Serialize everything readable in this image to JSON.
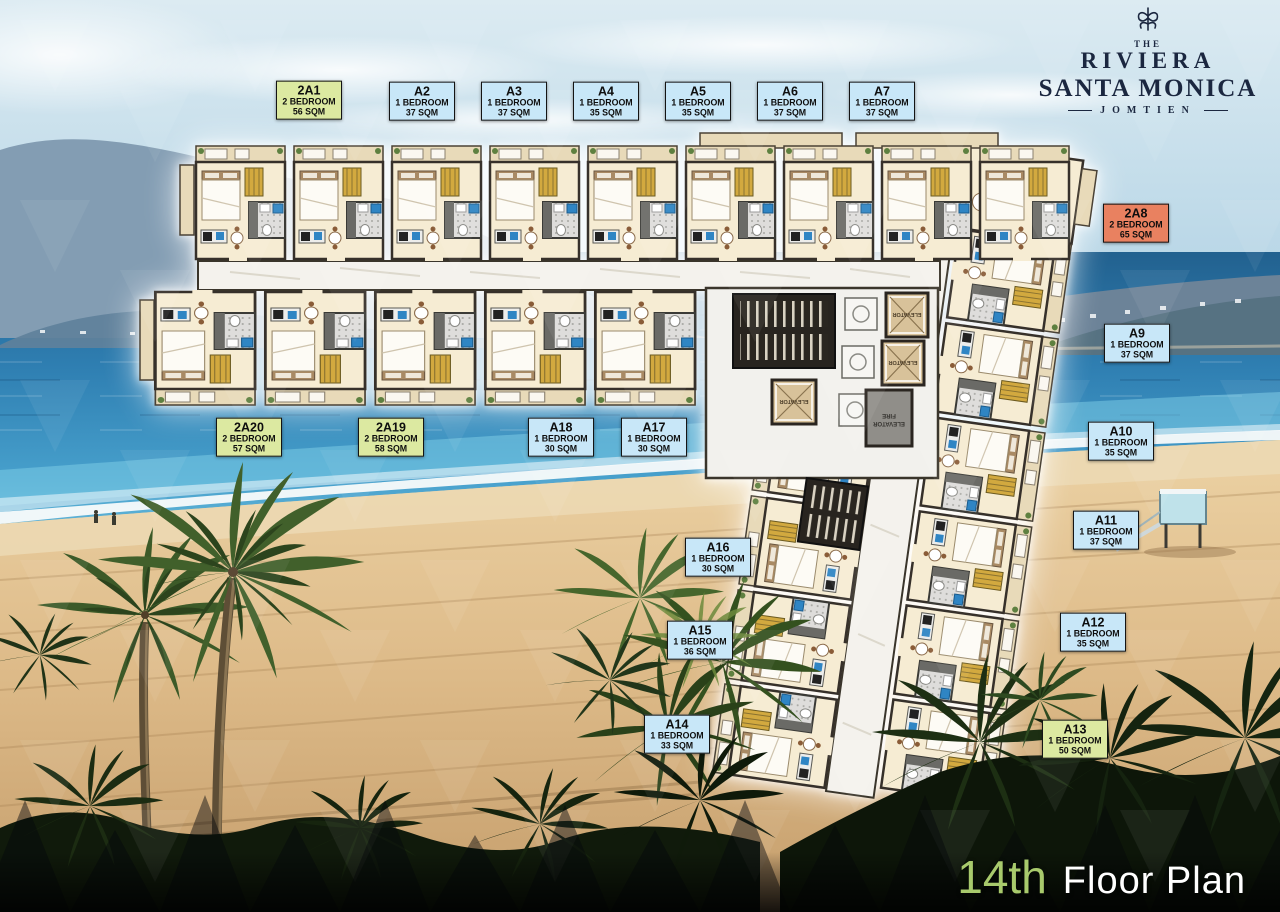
{
  "brand": {
    "the": "THE",
    "riviera": "RIVIERA",
    "santa_monica": "SANTA MONICA",
    "jomtien": "JOMTIEN"
  },
  "footer": {
    "floor_number": "14th",
    "floor_plan": "Floor Plan"
  },
  "core_labels": {
    "elevator": "ELEVATOR",
    "fire": "FIRE",
    "fire_elevator": "ELEVATOR"
  },
  "label_colors": {
    "green": "#dce9a1",
    "blue": "#c8e7f8",
    "orange": "#e98160"
  },
  "unit_labels": [
    {
      "id": "2A1",
      "type": "2 BEDROOM",
      "area": "56 SQM",
      "variant": "green",
      "cx": 309,
      "cy": 100
    },
    {
      "id": "A2",
      "type": "1 BEDROOM",
      "area": "37 SQM",
      "variant": "blue",
      "cx": 422,
      "cy": 101
    },
    {
      "id": "A3",
      "type": "1 BEDROOM",
      "area": "37 SQM",
      "variant": "blue",
      "cx": 514,
      "cy": 101
    },
    {
      "id": "A4",
      "type": "1 BEDROOM",
      "area": "35 SQM",
      "variant": "blue",
      "cx": 606,
      "cy": 101
    },
    {
      "id": "A5",
      "type": "1 BEDROOM",
      "area": "35 SQM",
      "variant": "blue",
      "cx": 698,
      "cy": 101
    },
    {
      "id": "A6",
      "type": "1 BEDROOM",
      "area": "37 SQM",
      "variant": "blue",
      "cx": 790,
      "cy": 101
    },
    {
      "id": "A7",
      "type": "1 BEDROOM",
      "area": "37 SQM",
      "variant": "blue",
      "cx": 882,
      "cy": 101
    },
    {
      "id": "2A8",
      "type": "2 BEDROOM",
      "area": "65 SQM",
      "variant": "orange",
      "cx": 1136,
      "cy": 223
    },
    {
      "id": "A9",
      "type": "1 BEDROOM",
      "area": "37 SQM",
      "variant": "blue",
      "cx": 1137,
      "cy": 343
    },
    {
      "id": "A10",
      "type": "1 BEDROOM",
      "area": "35 SQM",
      "variant": "blue",
      "cx": 1121,
      "cy": 441
    },
    {
      "id": "A11",
      "type": "1 BEDROOM",
      "area": "37 SQM",
      "variant": "blue",
      "cx": 1106,
      "cy": 530
    },
    {
      "id": "A12",
      "type": "1 BEDROOM",
      "area": "35 SQM",
      "variant": "blue",
      "cx": 1093,
      "cy": 632
    },
    {
      "id": "A13",
      "type": "1 BEDROOM",
      "area": "50 SQM",
      "variant": "green",
      "cx": 1075,
      "cy": 739
    },
    {
      "id": "A14",
      "type": "1 BEDROOM",
      "area": "33 SQM",
      "variant": "blue",
      "cx": 677,
      "cy": 734
    },
    {
      "id": "A15",
      "type": "1 BEDROOM",
      "area": "36 SQM",
      "variant": "blue",
      "cx": 700,
      "cy": 640
    },
    {
      "id": "A16",
      "type": "1 BEDROOM",
      "area": "30 SQM",
      "variant": "blue",
      "cx": 718,
      "cy": 557
    },
    {
      "id": "A17",
      "type": "1 BEDROOM",
      "area": "30 SQM",
      "variant": "blue",
      "cx": 654,
      "cy": 437
    },
    {
      "id": "A18",
      "type": "1 BEDROOM",
      "area": "30 SQM",
      "variant": "blue",
      "cx": 561,
      "cy": 437
    },
    {
      "id": "2A19",
      "type": "2 BEDROOM",
      "area": "58 SQM",
      "variant": "green",
      "cx": 391,
      "cy": 437
    },
    {
      "id": "2A20",
      "type": "2 BEDROOM",
      "area": "57 SQM",
      "variant": "green",
      "cx": 249,
      "cy": 437
    }
  ]
}
